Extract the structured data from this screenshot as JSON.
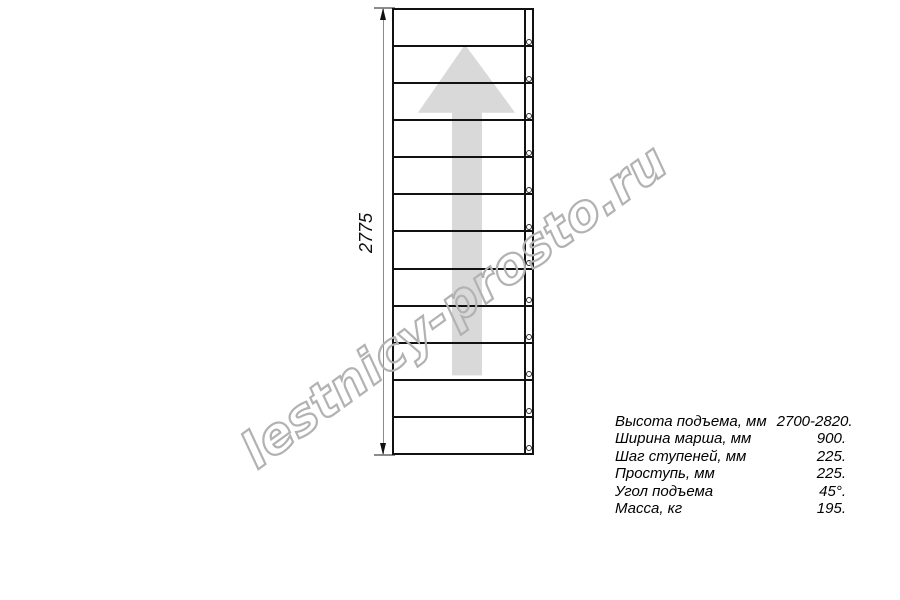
{
  "watermark": {
    "text": "lestnicy-prosto.ru"
  },
  "drawing": {
    "type": "straight-staircase-top-view",
    "height_dimension_label": "2775",
    "steps_count": 12,
    "direction_arrow": "up"
  },
  "colors": {
    "line": "#111111",
    "dim": "#8c8c8c",
    "arrow": "#d9d9d9",
    "watermark": "#b2b2b2",
    "text": "#000000"
  },
  "specs": [
    {
      "label": "Высота подъема, мм",
      "value": "2700-2820."
    },
    {
      "label": "Ширина марша, мм",
      "value": "900."
    },
    {
      "label": "Шаг ступеней, мм",
      "value": "225."
    },
    {
      "label": "Проступь, мм",
      "value": "225."
    },
    {
      "label": "Угол подъема",
      "value": "45°."
    },
    {
      "label": "Масса, кг",
      "value": "195."
    }
  ]
}
